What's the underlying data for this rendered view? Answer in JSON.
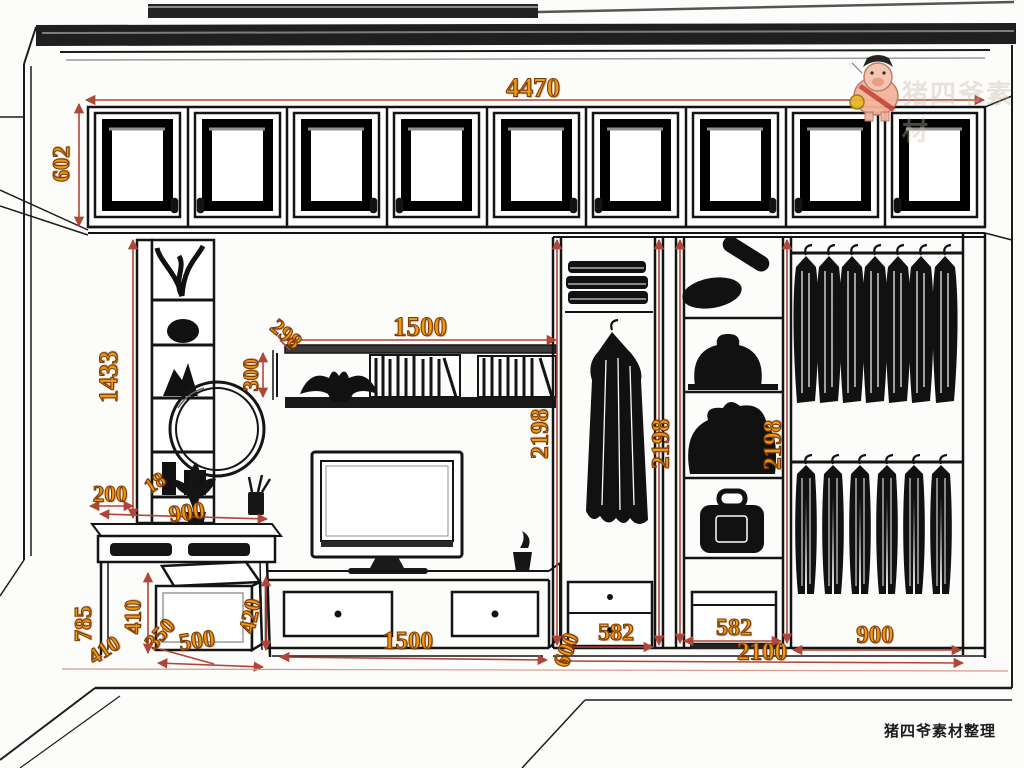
{
  "drawing": {
    "description": "Perspective line drawing of a bedroom wall unit: upper cabinet row, display shelf, mirror, dressing table with stool, wall shelf, TV cabinet and wardrobe with hanging clothes; dimensions in mm"
  },
  "dims": {
    "total_width": "4470",
    "upper_cabinet_height": "602",
    "left_bookcase_height": "1433",
    "wall_shelf_depth": "298",
    "wall_shelf_height": "300",
    "wall_shelf_width": "1500",
    "hanging_height_left": "2198",
    "hanging_height_mid": "2198",
    "hanging_height_right": "2198",
    "dresser_depth": "200",
    "panel_thickness": "18",
    "dresser_width": "900",
    "dresser_height": "785",
    "stool_height": "410",
    "stool_base": "410",
    "stool_depth": "350",
    "stool_width": "500",
    "tv_cabinet_height": "420",
    "tv_cabinet_width": "1500",
    "wardrobe_depth": "600",
    "wardrobe_section_left": "582",
    "wardrobe_section_mid": "582",
    "wardrobe_total_width": "2100",
    "hanging_section_width": "900"
  },
  "watermark": {
    "mascot": "pig-mascot",
    "faint_text": "猪四爷素材",
    "credit": "猪四爷素材整理"
  },
  "colors": {
    "dimension_text": "#ef9a12",
    "dimension_line": "#b0453a",
    "drawing_line": "#161616",
    "background": "#fcfcfa"
  }
}
